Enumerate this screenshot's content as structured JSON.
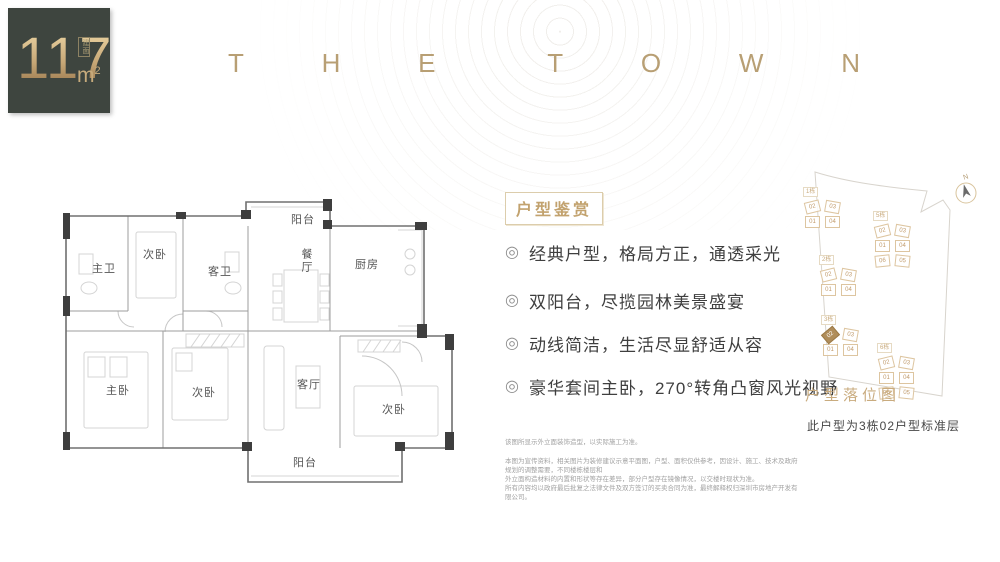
{
  "badge": {
    "area_value": "117",
    "area_unit_base": "m",
    "area_unit_sup": "2",
    "area_label": "建面"
  },
  "brand": {
    "letters": [
      "T",
      "H",
      "E",
      "T",
      "O",
      "W",
      "N"
    ]
  },
  "floorplan": {
    "rooms": {
      "master_bath": "主卫",
      "bedroom_top": "次卧",
      "guest_bath": "客卫",
      "balcony_top": "阳台",
      "dining": "餐厅",
      "kitchen": "厨房",
      "master_bedroom": "主卧",
      "bedroom_left": "次卧",
      "living": "客厅",
      "bedroom_right": "次卧",
      "balcony_bottom": "阳台"
    }
  },
  "features": {
    "title": "户型鉴赏",
    "bullet_icon": "◎",
    "items": [
      "经典户型，格局方正，通透采光",
      "双阳台，尽揽园林美景盛宴",
      "动线简洁，生活尽显舒适从容",
      "豪华套间主卧，270°转角凸窗风光视野"
    ]
  },
  "sitemap": {
    "title": "户型落位图",
    "caption": "此户型为3栋02户型标准层",
    "compass_label": "N",
    "clusters": [
      {
        "label": "1栋",
        "units": [
          "02",
          "03",
          "01",
          "04"
        ]
      },
      {
        "label": "2栋",
        "units": [
          "02",
          "03",
          "01",
          "04"
        ]
      },
      {
        "label": "3栋",
        "units": [
          "02",
          "03",
          "01",
          "04"
        ],
        "highlighted_unit": "02"
      },
      {
        "label": "5栋",
        "units": [
          "02",
          "03",
          "01",
          "04",
          "06",
          "05"
        ]
      },
      {
        "label": "6栋",
        "units": [
          "02",
          "03",
          "01",
          "04",
          "06",
          "05"
        ]
      }
    ]
  },
  "disclaimer": {
    "intro": "该图所显示外立面装饰造型，以实际施工为准。",
    "body": [
      "本图为宣传资料，相关图片为装修建议示意平面图，户型、面积仅供参考，因设计、施工、技术及政府规划的调整需要，不同楼栋楼层和",
      "外立面构造材料的内置和形状等存在差异，部分户型存在镜像情况，以交楼时现状为准。",
      "所有内容均以政府最后批复之法律文件及双方签订的买卖合同为准，最终解释权归深圳市房地产开发有限公司。"
    ]
  },
  "colors": {
    "badge_bg": "#3e453f",
    "gold": "#bfa27a",
    "gold_dark": "#a9854f",
    "text_dark": "#3f3f3f",
    "map_highlight": "#b08d5a"
  }
}
